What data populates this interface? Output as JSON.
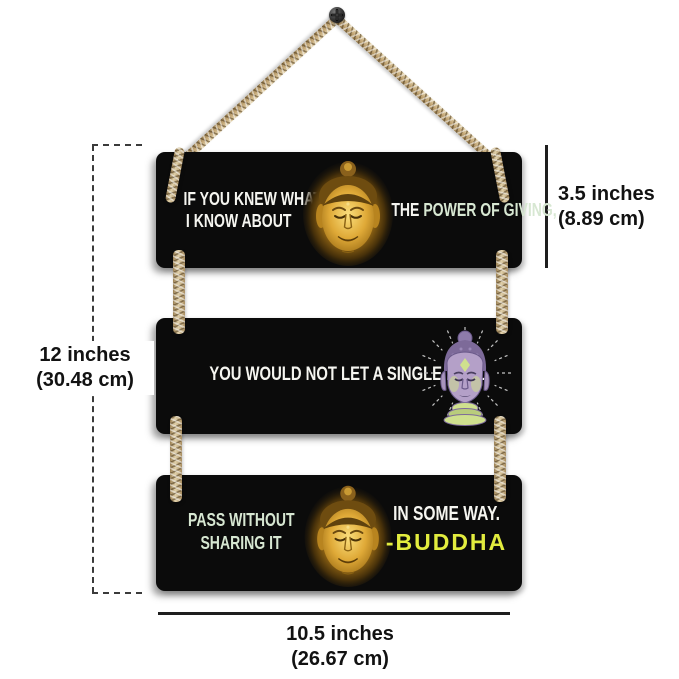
{
  "artwork": {
    "plank1": {
      "left_lines": [
        "IF YOU KNEW WHAT",
        "I KNOW ABOUT"
      ],
      "right_prefix": "THE ",
      "right_highlight": "POWER OF GIVING,"
    },
    "plank2": {
      "line": "YOU WOULD NOT LET A SINGLE MEAL"
    },
    "plank3": {
      "left_lines": [
        "PASS WITHOUT",
        "SHARING IT"
      ],
      "right_line": "IN SOME WAY.",
      "signature": "-BUDDHA"
    }
  },
  "dimensions": {
    "total_height": [
      "12 inches",
      "(30.48 cm)"
    ],
    "plank_height": [
      "3.5 inches",
      "(8.89 cm)"
    ],
    "width": [
      "10.5 inches",
      "(26.67 cm)"
    ]
  },
  "colors": {
    "plank_background": "#0b0b0b",
    "quote_white": "#f5f5f0",
    "quote_green": "#d7e7d2",
    "signature_yellow": "#e2ec3e",
    "rope_light": "#e0d0aa",
    "rope_dark": "#9a8053",
    "dimension_text": "#121212"
  }
}
